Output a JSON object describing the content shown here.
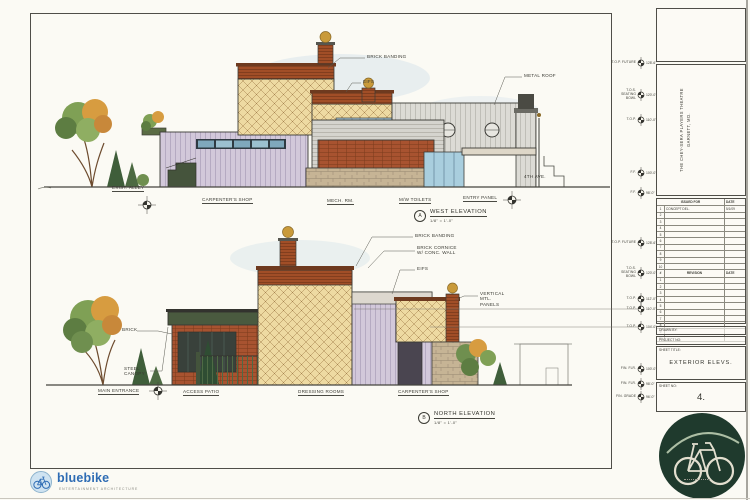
{
  "west": {
    "ref_letter": "A",
    "title": "WEST ELEVATION",
    "scale": "1/8\" = 1'-0\"",
    "labels": {
      "brick_banding": "BRICK BANDING",
      "eifs": "EIFS",
      "metal_roof": "METAL ROOF",
      "exist_alley": "EXIST. ALLEY",
      "carpenters_shop": "CARPENTER'S SHOP",
      "mech_rm": "MECH. RM.",
      "mw_toilets": "M/W TOILETS",
      "entry_panel": "ENTRY PANEL",
      "fourth_ave": "4TH AVE."
    },
    "markers": [
      {
        "label": "T.O.P. FUTURE",
        "elev": "128'-6\""
      },
      {
        "label": "T.O.S. SEATING BOWL",
        "elev": "120'-0\""
      },
      {
        "label": "T.O.P.",
        "elev": "110'-0\""
      },
      {
        "label": "F.F.",
        "elev": "100'-0\""
      },
      {
        "label": "F.F.",
        "elev": "98'-0\""
      }
    ]
  },
  "north": {
    "ref_letter": "B",
    "title": "NORTH ELEVATION",
    "scale": "1/8\" = 1'-0\"",
    "labels": {
      "brick_banding": "BRICK BANDING",
      "brick_cornice": "BRICK CORNICE W/ CONC. WALL",
      "eifs": "EIFS",
      "mtl_panels": "VERTICAL MTL. PANELS",
      "brick": "BRICK",
      "steel_canopy": "STEEL CANOPY",
      "main_entrance": "MAIN ENTRANCE",
      "access_patio": "ACCESS PATIO",
      "dressing_rooms": "DRESSING ROOMS",
      "carpenters_shop": "CARPENTER'S SHOP"
    },
    "markers": [
      {
        "label": "T.O.P. FUTURE",
        "elev": "128'-6\""
      },
      {
        "label": "T.O.S. SEATING BOWL",
        "elev": "120'-0\""
      },
      {
        "label": "T.O.P.",
        "elev": "112'-0\""
      },
      {
        "label": "T.O.P.",
        "elev": "110'-0\""
      },
      {
        "label": "T.O.P.",
        "elev": "104'-0\""
      },
      {
        "label": "FIN. FLR.",
        "elev": "100'-0\""
      },
      {
        "label": "FIN. FLR.",
        "elev": "98'-0\""
      },
      {
        "label": "FIN. GRADE",
        "elev": "96'-0\""
      }
    ]
  },
  "titleblock": {
    "project_name": "THE CHEY-SERA PLAYERS THEATRE",
    "project_location": "GARNETT, MO.",
    "issued": {
      "col_issued": "ISSUED FOR",
      "col_date": "DATE",
      "first_row": {
        "text": "CONCEPT DEL.",
        "date": "5/1/09"
      }
    },
    "revision": {
      "col_no": "#",
      "col_revision": "REVISION",
      "col_date": "DATE"
    },
    "rows": [
      "1",
      "2",
      "3",
      "4",
      "5",
      "6",
      "7",
      "8",
      "9",
      "10"
    ],
    "drawn_by": "DRAWN BY:",
    "project_no": "PROJECT NO:",
    "sheet_title_label": "SHEET TITLE:",
    "sheet_title": "EXTERIOR ELEVS.",
    "sheet_no_label": "SHEET NO:",
    "sheet_no": "4."
  },
  "footer": {
    "logo_name": "bluebike",
    "logo_tagline": "ENTERTAINMENT ARCHITECTURE"
  },
  "colors": {
    "paper": "#fbfaf4",
    "ink": "#3a3a33",
    "diamond_wall": "#eedaa2",
    "brick": "#a14e27",
    "lavender_siding": "#d2c8da",
    "stone": "#c6b495",
    "glass": "#a6cbdd",
    "foliage_green": "#7fa055",
    "foliage_orange": "#d79c40",
    "logo_blue": "#2e6cb4",
    "logo_circle_green": "#1f3a2d"
  }
}
